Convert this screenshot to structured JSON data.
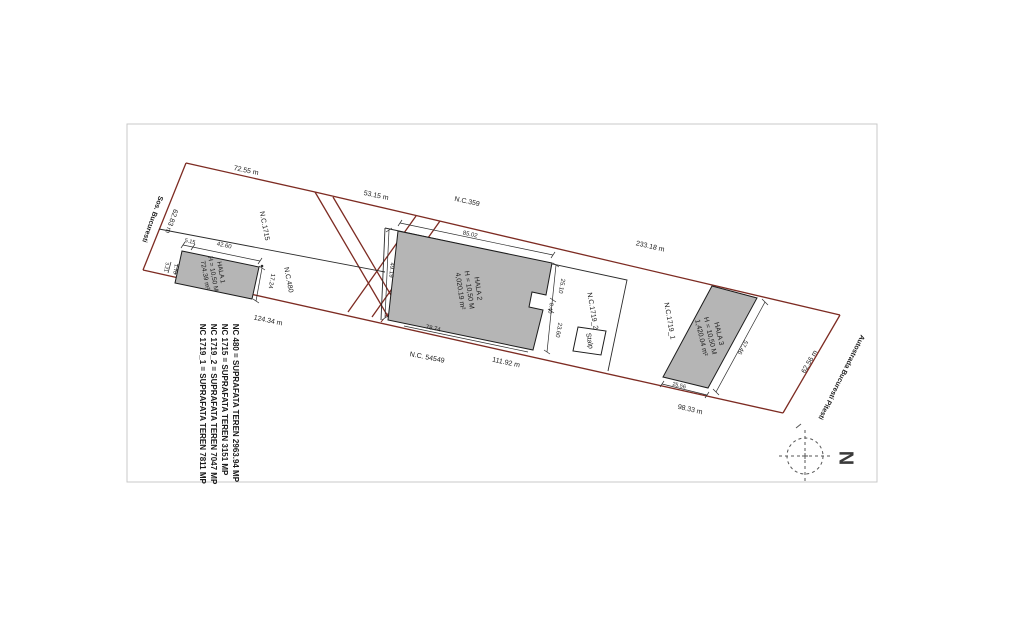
{
  "plan": {
    "roads": {
      "left": "Sos. Bucuresti",
      "right": "Autostrada Bucuresti Pitesti"
    },
    "parcel_labels": {
      "nc1715": "N.C.1715",
      "nc480": "N.C.480",
      "nc359": "N.C.359",
      "nc54549": "N.C. 54549",
      "nc1719_1": "N.C.1719_1",
      "nc1719_2": "N.C.1719_2"
    },
    "boundary_dimensions": {
      "top_left": "72.55 m",
      "top_middle": "53.15 m",
      "top_right": "233.18 m",
      "left": "62.83 m",
      "right": "62.56 m",
      "bottom_left": "124.34 m",
      "bottom_middle": "111.92 m",
      "bottom_right": "98.33 m"
    },
    "buildings": [
      {
        "name": "HALA 1",
        "height": "H = 10,50 M",
        "area": "724.39 m²",
        "dims": {
          "top": "42.60",
          "top_offset": "5.15",
          "side": "17.24",
          "left_a": "3.21",
          "left_b": "1.70"
        }
      },
      {
        "name": "HALA 2",
        "height": "H = 10,50 M",
        "area": "4,020.19 m²",
        "dims": {
          "top": "85.02",
          "left": "49.19",
          "right_upper": "25.10",
          "notch": "8.40",
          "right_lower": "23.60",
          "bottom": "78.74"
        }
      },
      {
        "name": "HALA 3",
        "height": "H = 10,50 M",
        "area": "1,420.04 m²",
        "dims": {
          "side": "57.46",
          "bottom": "25.56"
        }
      }
    ],
    "structures": {
      "pole": "Stalp"
    },
    "legend_lines": [
      "NC 1719_1 = SUPRAFATA TEREN 7811 MP",
      "NC 1719_2 = SUPRAFATA TEREN 7047 MP",
      "NC 1715 = SUPRAFATA TEREN 3151 MP",
      "NC 480 = SUPRAFATA TEREN 2963.94 MP"
    ],
    "compass": {
      "north": "N"
    },
    "colors": {
      "boundary_red": "#7d2b22",
      "line_black": "#2b2b2b",
      "building_fill": "#b5b5b5",
      "page_border": "#c9c9c9"
    }
  }
}
